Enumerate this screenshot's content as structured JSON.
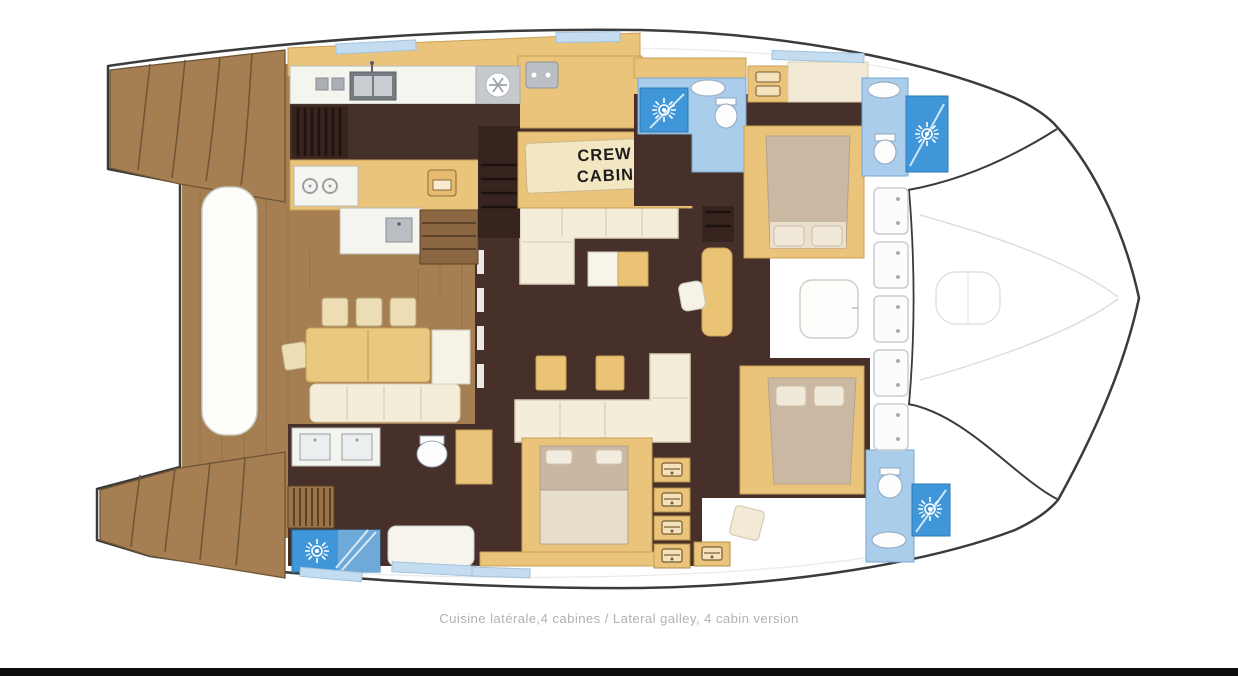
{
  "caption": "Cuisine latérale,4 cabines / Lateral galley, 4 cabin version",
  "labels": {
    "crew_cabin_line1": "CREW",
    "crew_cabin_line2": "CABIN"
  },
  "colors": {
    "background": "#ffffff",
    "hull_outline": "#3b3b3b",
    "teak_wood": "#a57e51",
    "teak_line": "#6f5535",
    "dark_floor": "#48302a",
    "stair_dark": "#37241e",
    "cabinet_tan": "#eac47a",
    "upholstery_cream": "#f4edda",
    "bed_taupe": "#cbb8a2",
    "counter_white": "#f5f5f0",
    "counter_gray": "#c6cacd",
    "bathroom_light_blue": "#a9cdea",
    "shower_blue": "#3f96d8",
    "window_blue": "#c3dcef",
    "crew_panel": "#f3e6c3",
    "caption_gray": "#b2b2b2",
    "footer_bar": "#0d0d0d"
  },
  "icons": {
    "shower_icon": "sunburst",
    "extractor_fan_icon": "snowflake",
    "deck_hatch_icon": "rounded-square-with-hinge-dots",
    "sink_icon": "oval-basin",
    "toilet_icon": "oval-bowl",
    "stove_icon": "two-burner-circles",
    "oven_icon": "square-with-window",
    "locker_icon": "vent-drawer"
  }
}
